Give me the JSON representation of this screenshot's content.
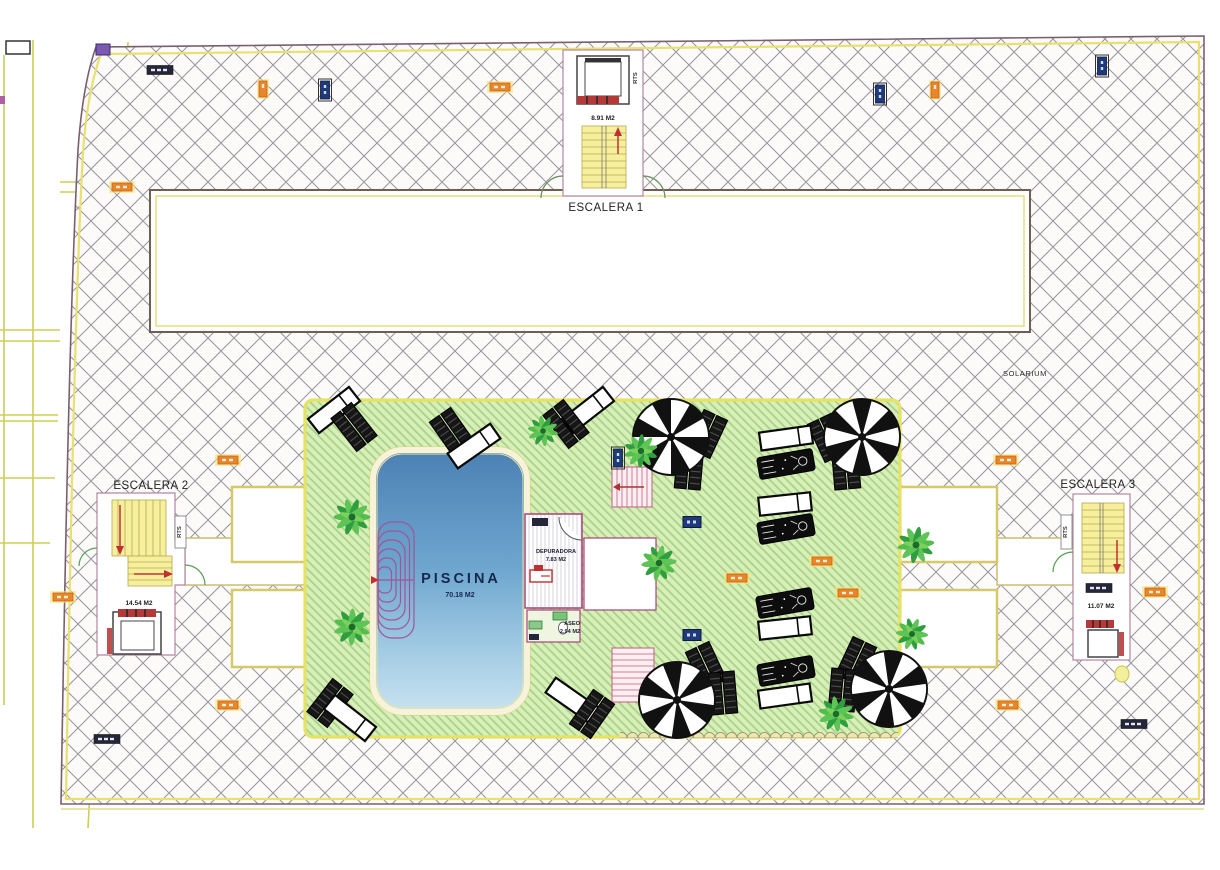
{
  "drawing": {
    "type": "architectural-site-plan",
    "labels": {
      "escalera1_title": "ESCALERA 1",
      "escalera1_area": "8.91 M2",
      "escalera2_title": "ESCALERA 2",
      "escalera2_area": "14.54 M2",
      "escalera3_title": "ESCALERA 3",
      "escalera3_area": "11.07 M2",
      "rts": "RTS",
      "solarium": "SOLARIUM",
      "piscina_title": "PISCINA",
      "piscina_area": "70.18 M2",
      "depuradora_title": "DEPURADORA",
      "depuradora_area": "7.83 M2",
      "aseo_title": "ASEO",
      "aseo_area": "2.94 M2"
    },
    "colors": {
      "boundary_line": "#7c5f6e",
      "boundary_inner_yellow": "#e9e06e",
      "hatch_line": "#97959d",
      "garden_fill": "#d9eeb8",
      "garden_hatch": "#a3d387",
      "garden_border": "#e6e262",
      "pool_top": "#4c80b4",
      "pool_bottom": "#c8e2f0",
      "lane_line": "#a05596",
      "stair_fill": "#f6f09e",
      "room_outline": "#b487a0",
      "wet_room_outline": "#a8447a",
      "accent_red": "#c03030",
      "badge_orange": "#e8862a",
      "badge_navy": "#1f3a7a",
      "badge_dark": "#26263a",
      "palm_green": "#3fae4d",
      "parasol_black": "#111111"
    },
    "icons": [
      "palm-tree-icon",
      "parasol-icon",
      "sunbed-icon",
      "double-lounger-icon",
      "occupied-lounger-icon",
      "elevator-icon",
      "stair-arrow-icon",
      "drain-badge-icon",
      "level-badge-icon"
    ]
  }
}
